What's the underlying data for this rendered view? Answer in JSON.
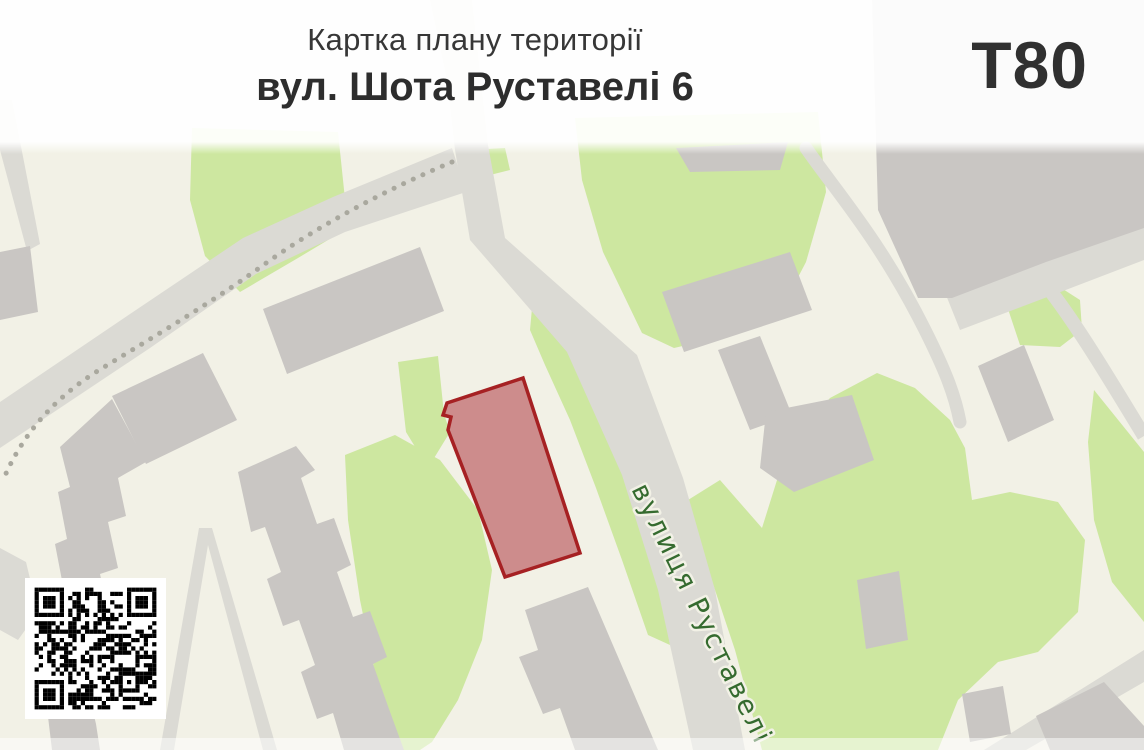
{
  "header": {
    "title_line1": "Картка плану території",
    "title_line2": "вул. Шота Руставелі 6",
    "code": "T80"
  },
  "map": {
    "street_label": "вулиця Руставелі",
    "highlight": "target-parcel"
  },
  "qr": {
    "name": "qr-code",
    "modules": 29
  },
  "colors": {
    "background": "#f2f1e6",
    "green": "#cde7a0",
    "road": "#dbdad4",
    "building": "#c9c6c3",
    "parcel_fill": "#cd8c8c",
    "parcel_border": "#a62123",
    "street_label_color": "#356b2f"
  }
}
